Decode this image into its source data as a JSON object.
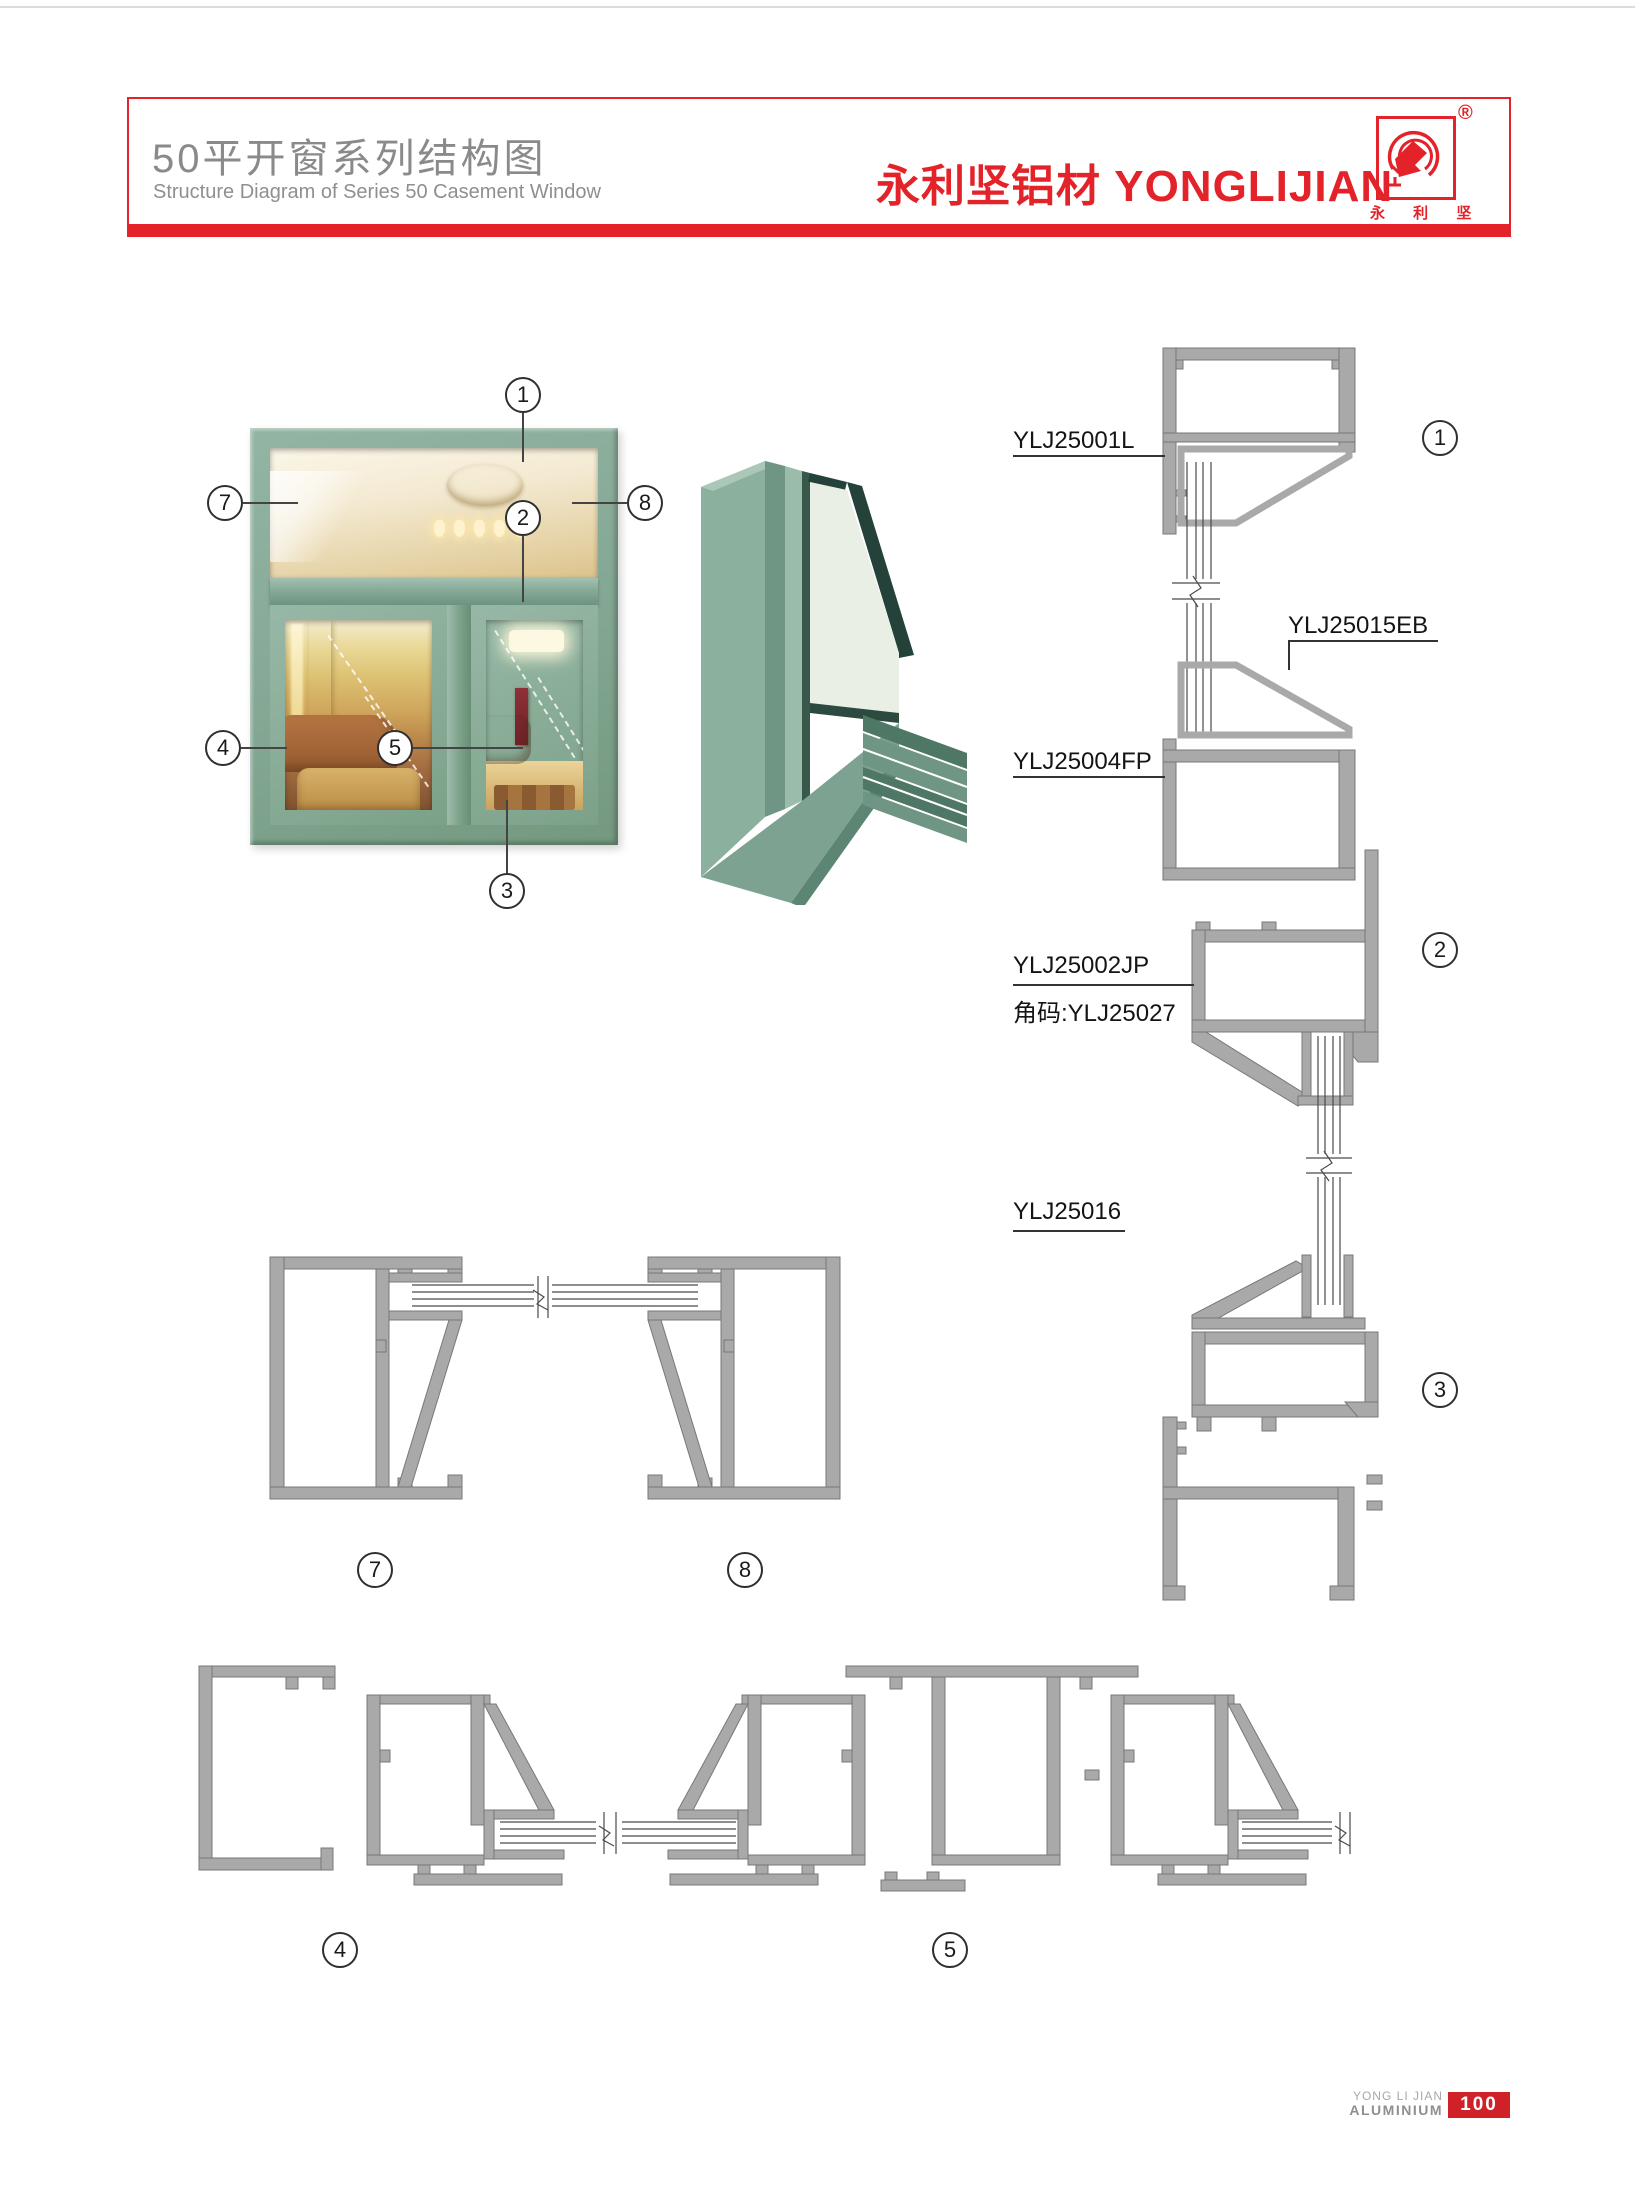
{
  "header": {
    "title_cn": "50平开窗系列结构图",
    "title_en": "Structure Diagram of Series 50 Casement Window",
    "brand_text": "永利坚铝材 YONGLIJIAN",
    "logo_sub": "永 利 坚",
    "registered": "®",
    "accent_red": "#e32229"
  },
  "callouts": {
    "c1": "1",
    "c2": "2",
    "c3": "3",
    "c4": "4",
    "c5": "5",
    "c7": "7",
    "c8": "8"
  },
  "profile_labels": {
    "l1": "YLJ25001L",
    "l2": "YLJ25015EB",
    "l3": "YLJ25004FP",
    "l4": "YLJ25002JP",
    "l5": "角码:YLJ25027",
    "l6": "YLJ25016"
  },
  "footer": {
    "line1": "YONG LI JIAN",
    "line2": "ALUMINIUM",
    "page_number": "100"
  },
  "colors": {
    "frame_green": "#86aa97",
    "drawing_gray": "#a9a9a9",
    "accent_red": "#e32229"
  }
}
